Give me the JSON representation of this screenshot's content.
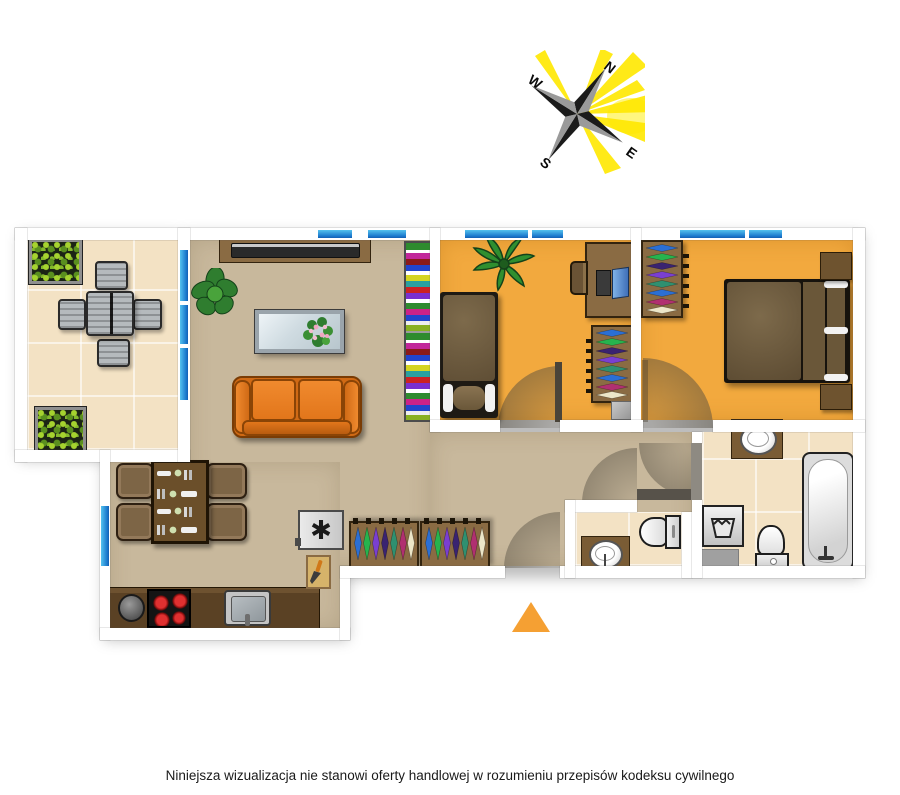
{
  "compass": {
    "north": "N",
    "east": "E",
    "south": "S",
    "west": "W"
  },
  "caption": "Niniejsza wizualizacja nie stanowi oferty handlowej w rozumieniu przepisów kodeksu cywilnego",
  "icons": {
    "fridge_symbol": "✱"
  },
  "entrance_marker_color": "#F5A033",
  "palette": {
    "background": "#FFFFFF",
    "wall": "#FFFFFF",
    "window_glass": "#2E9BD6",
    "floor_main": "#C8B89C",
    "floor_bedroom": "#F2A93E",
    "floor_tile": "#F3E2C4",
    "sofa_orange": "#E2761B",
    "furniture_wood": "#8A6B43",
    "counter_wood": "#5A4124",
    "compass_ray_yellow": "#FFE800",
    "stove_burner_red": "#D81818"
  }
}
